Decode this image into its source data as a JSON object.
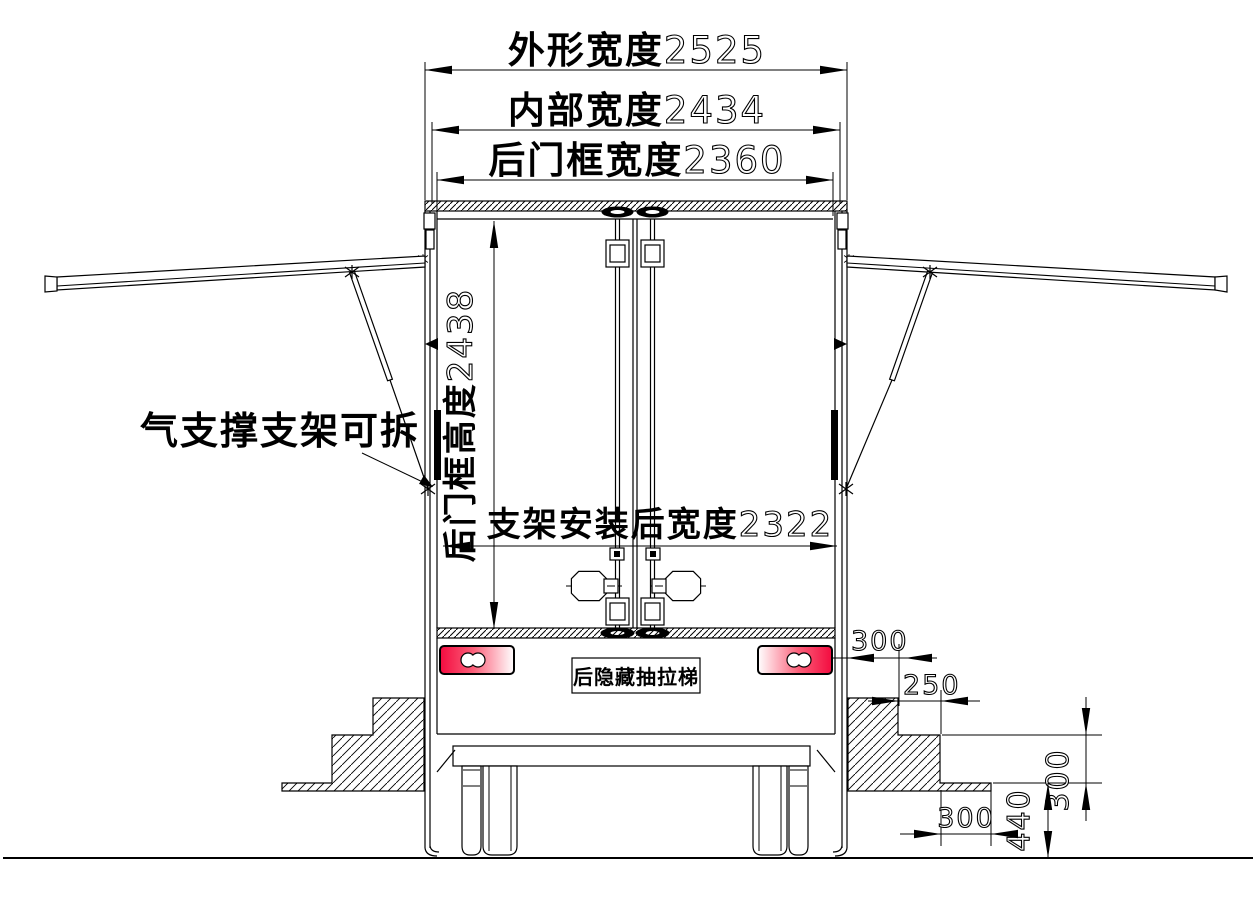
{
  "dimensions": {
    "outer_width": {
      "label": "外形宽度",
      "value": "2525"
    },
    "inner_width": {
      "label": "内部宽度",
      "value": "2434"
    },
    "door_frame_width": {
      "label": "后门框宽度",
      "value": "2360"
    },
    "door_frame_height": {
      "label": "后门框高度",
      "value": "2438"
    },
    "bracket_width": {
      "label": "支架安装后宽度",
      "value": "2322"
    },
    "taillight_offset": "300",
    "step_depth": "250",
    "step_height": "300",
    "step_width": "300",
    "ground_clearance": "440"
  },
  "annotations": {
    "gas_strut": "气支撑支架可拆",
    "ladder": "后隐藏抽拉梯"
  },
  "colors": {
    "line": "#000000",
    "background": "#ffffff",
    "taillight_red": "#f30b3f",
    "taillight_fade": "#ffffff"
  }
}
